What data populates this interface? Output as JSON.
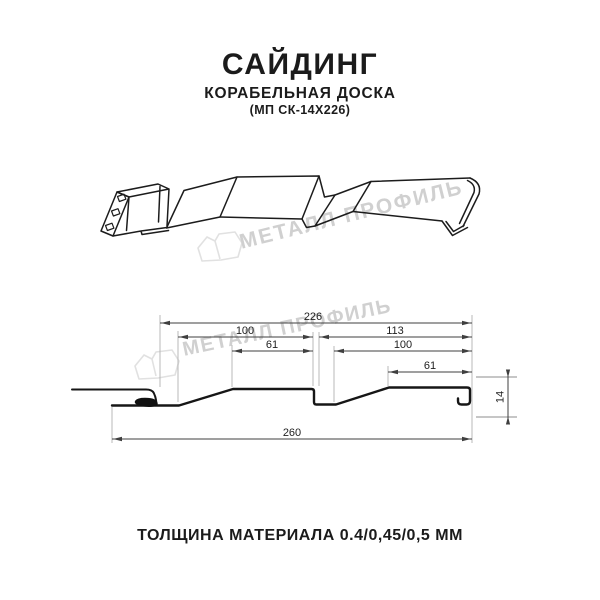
{
  "header": {
    "title": "САЙДИНГ",
    "subtitle": "КОРАБЕЛЬНАЯ ДОСКА",
    "model_code": "(МП СК-14Х226)"
  },
  "watermark": {
    "brand_text": "МЕТАЛЛ ПРОФИЛЬ",
    "text_color": "#d0d0d0",
    "logo_color": "#e1e1e1"
  },
  "section_drawing": {
    "dimensions_mm": {
      "overall_lock_to_edge": "226",
      "left_board_width": "100",
      "right_span": "113",
      "left_board_flat": "61",
      "right_board_width": "100",
      "right_board_flat": "61",
      "total_width": "260",
      "profile_height": "14"
    }
  },
  "footer": {
    "thickness_note": "ТОЛЩИНА МАТЕРИАЛА 0.4/0,45/0,5 ММ"
  },
  "colors": {
    "background": "#ffffff",
    "line_art": "#1a1a1a",
    "dimension_lines": "#3f3f3f",
    "extension_lines": "#b8b8b8"
  }
}
